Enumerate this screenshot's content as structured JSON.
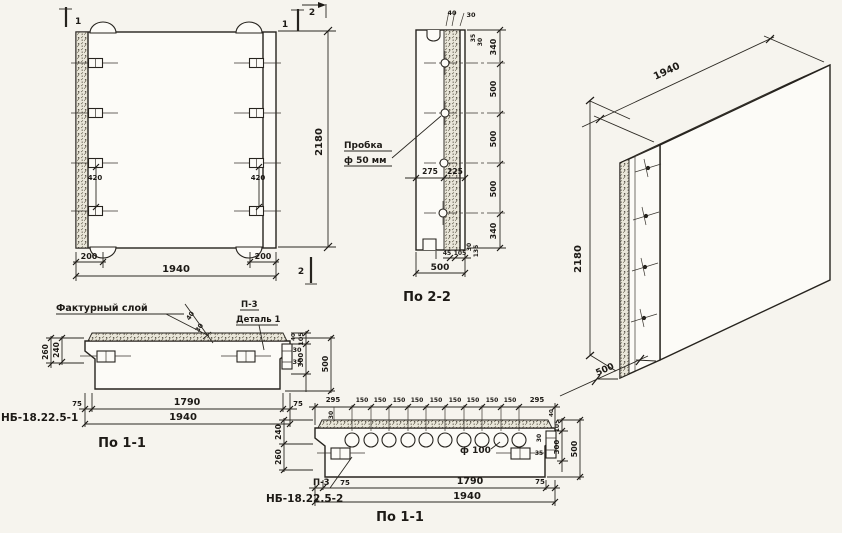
{
  "front_view": {
    "width_total": "1940",
    "height_total": "2180",
    "edge_left": "200",
    "edge_right": "200",
    "tab_spacing_left": "420",
    "tab_spacing_right": "420",
    "cut_mark_top_left": "1",
    "cut_mark_top_right": "1",
    "cut_mark_top_2": "2",
    "cut_mark_bottom_2": "2"
  },
  "section_2_2": {
    "view_label": "По 2-2",
    "callout_line1": "Пробка",
    "callout_line2": "ф 50 мм",
    "dim_top_40": "40",
    "dim_top_30": "30",
    "dim_top_rot_35": "35",
    "dim_top_rot_30": "30",
    "dim_mid_left": "275",
    "dim_mid_right": "225",
    "dims_right": [
      "340",
      "500",
      "500",
      "500",
      "340"
    ],
    "dim_bot_45": "45",
    "dim_bot_105": "105",
    "dim_bot_total": "500",
    "dim_bot_rot_30": "30",
    "dim_bot_rot_135": "135"
  },
  "isometric": {
    "dim_length": "1940",
    "dim_height": "2180",
    "dim_depth": "500"
  },
  "section_1_1_a": {
    "part_mark": "НБ-18.22.5-1",
    "view_label": "По 1-1",
    "callout_texture": "Фактурный слой",
    "callout_p3": "П-3",
    "callout_detail": "Деталь 1",
    "dim_left_240": "240",
    "dim_left_260": "260",
    "dim_diag_40": "40",
    "dim_diag_30": "30",
    "dim_tab_30": "30",
    "dim_tab_35": "35",
    "dim_right_40": "40",
    "dim_right_105": "105",
    "dim_right_300": "300",
    "dim_right_500": "500",
    "dim_bot_75l": "75",
    "dim_bot_1790": "1790",
    "dim_bot_75r": "75",
    "dim_bot_total": "1940"
  },
  "section_1_1_b": {
    "part_mark": "НБ-18.22.5-2",
    "view_label": "По 1-1",
    "callout_p3": "П-3",
    "callout_hole": "ф 100",
    "dims_top": [
      "295",
      "150",
      "150",
      "150",
      "150",
      "150",
      "150",
      "150",
      "150",
      "150",
      "295"
    ],
    "dim_left_240": "240",
    "dim_left_260": "260",
    "dim_left_30": "30",
    "dim_tab_30": "30",
    "dim_tab_35": "35",
    "dim_right_40": "40",
    "dim_right_105": "105",
    "dim_right_300": "300",
    "dim_right_500": "500",
    "dim_bot_75l": "75",
    "dim_bot_1790": "1790",
    "dim_bot_75r": "75",
    "dim_bot_total": "1940"
  }
}
